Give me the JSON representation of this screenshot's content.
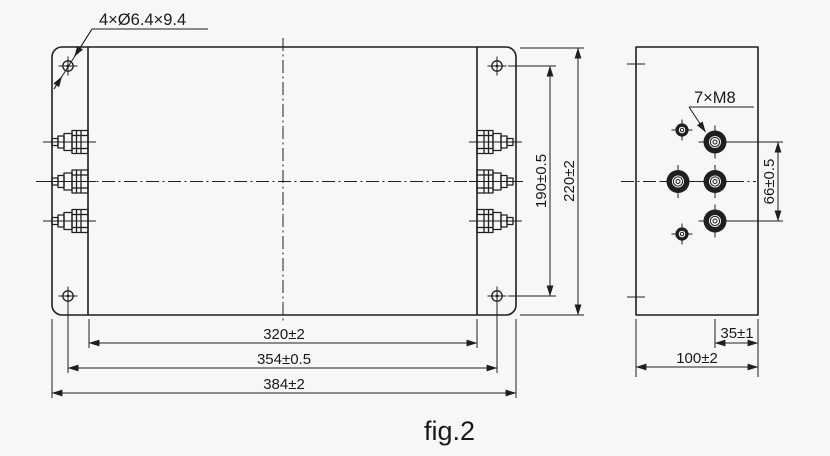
{
  "figure": {
    "caption": "fig.2"
  },
  "colors": {
    "background": "#f7f7f5",
    "line": "#1f1f1f",
    "text": "#1a1a1a"
  },
  "front_view": {
    "hole_callout": "4×Ø6.4×9.4",
    "dim_body_width": "320±2",
    "dim_hole_pitch_width": "354±0.5",
    "dim_overall_width": "384±2",
    "dim_hole_pitch_height": "190±0.5",
    "dim_overall_height": "220±2"
  },
  "side_view": {
    "terminal_callout": "7×M8",
    "dim_terminal_pitch": "66±0.5",
    "dim_terminal_offset": "35±1",
    "dim_depth": "100±2"
  }
}
